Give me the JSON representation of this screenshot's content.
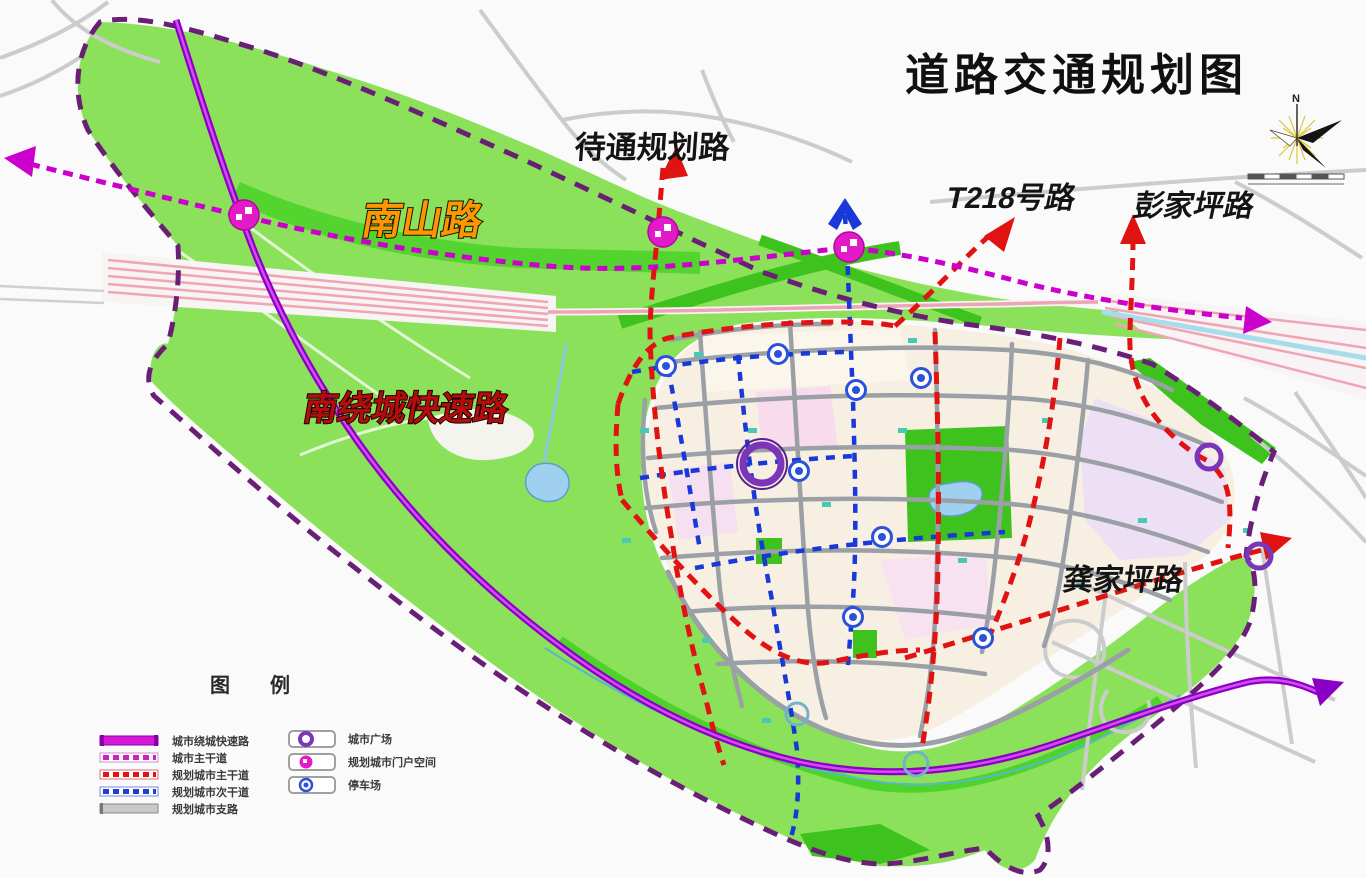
{
  "title": "道路交通规划图",
  "compass": {
    "north_label": "N"
  },
  "road_labels": {
    "pending_planned_road": "待通规划路",
    "nanshan_road": "南山路",
    "t218_road": "T218号路",
    "pengjiaping_road": "彭家坪路",
    "south_ring_expressway": "南绕城快速路",
    "gongjiaping_road": "龚家坪路"
  },
  "legend": {
    "title": "图例",
    "left_items": [
      {
        "label": "城市绕城快速路",
        "swatch": "expressway"
      },
      {
        "label": "城市主干道",
        "swatch": "arterial"
      },
      {
        "label": "规划城市主干道",
        "swatch": "planned-arterial"
      },
      {
        "label": "规划城市次干道",
        "swatch": "planned-secondary"
      },
      {
        "label": "规划城市支路",
        "swatch": "branch-road"
      }
    ],
    "right_items": [
      {
        "label": "城市广场",
        "swatch": "city-square"
      },
      {
        "label": "规划城市门户空间",
        "swatch": "gateway-node"
      },
      {
        "label": "停车场",
        "swatch": "parking"
      }
    ]
  },
  "colors": {
    "green_area": "#8be15a",
    "bright_green": "#3ec21d",
    "urban_area": "#f7f0e2",
    "expressway": "#8b00c4",
    "arterial_dashed": "#cc00cc",
    "planned_arterial": "#e01212",
    "planned_secondary": "#1838d8",
    "boundary": "#6a1f77",
    "water": "#9fd0f0",
    "railway": "#f0a4b4",
    "square_icon": "#7a35b8",
    "gateway_icon": "#e31ac8",
    "parking_icon": "#2b52d8"
  }
}
